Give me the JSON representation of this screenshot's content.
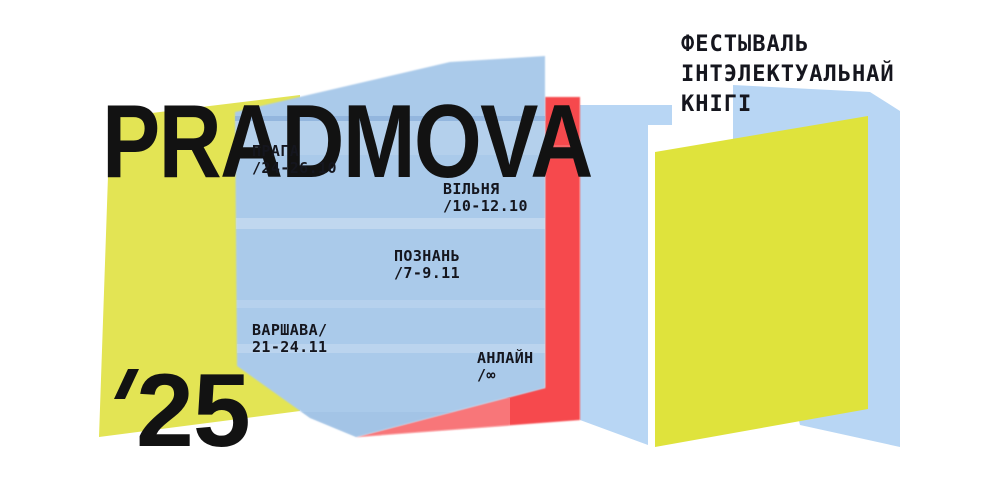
{
  "title": "PRADMOVA",
  "year": {
    "mark": "’",
    "digits": "25"
  },
  "subtitle": {
    "lines": [
      "ФЕСТЫВАЛЬ",
      "ІНТЭЛЕКТУАЛЬНАЙ",
      "КНІГІ"
    ]
  },
  "events": [
    {
      "city": "ПРАГА",
      "date": "/24-26.10"
    },
    {
      "city": "ВІЛЬНЯ",
      "date": "/10-12.10"
    },
    {
      "city": "ПОЗНАНЬ",
      "date": "/7-9.11"
    },
    {
      "city": "ВАРШАВА/",
      "date": "21-24.11"
    },
    {
      "city": "АНЛАЙН",
      "date": "/∞"
    }
  ],
  "colors": {
    "background": "#ffffff",
    "yellow_left": "#e3e454",
    "yellow_right": "#dfe33c",
    "blue_central": "#aacaea",
    "blue_light": "#b8d6f4",
    "red": "#f64a4e",
    "text": "#121212"
  }
}
